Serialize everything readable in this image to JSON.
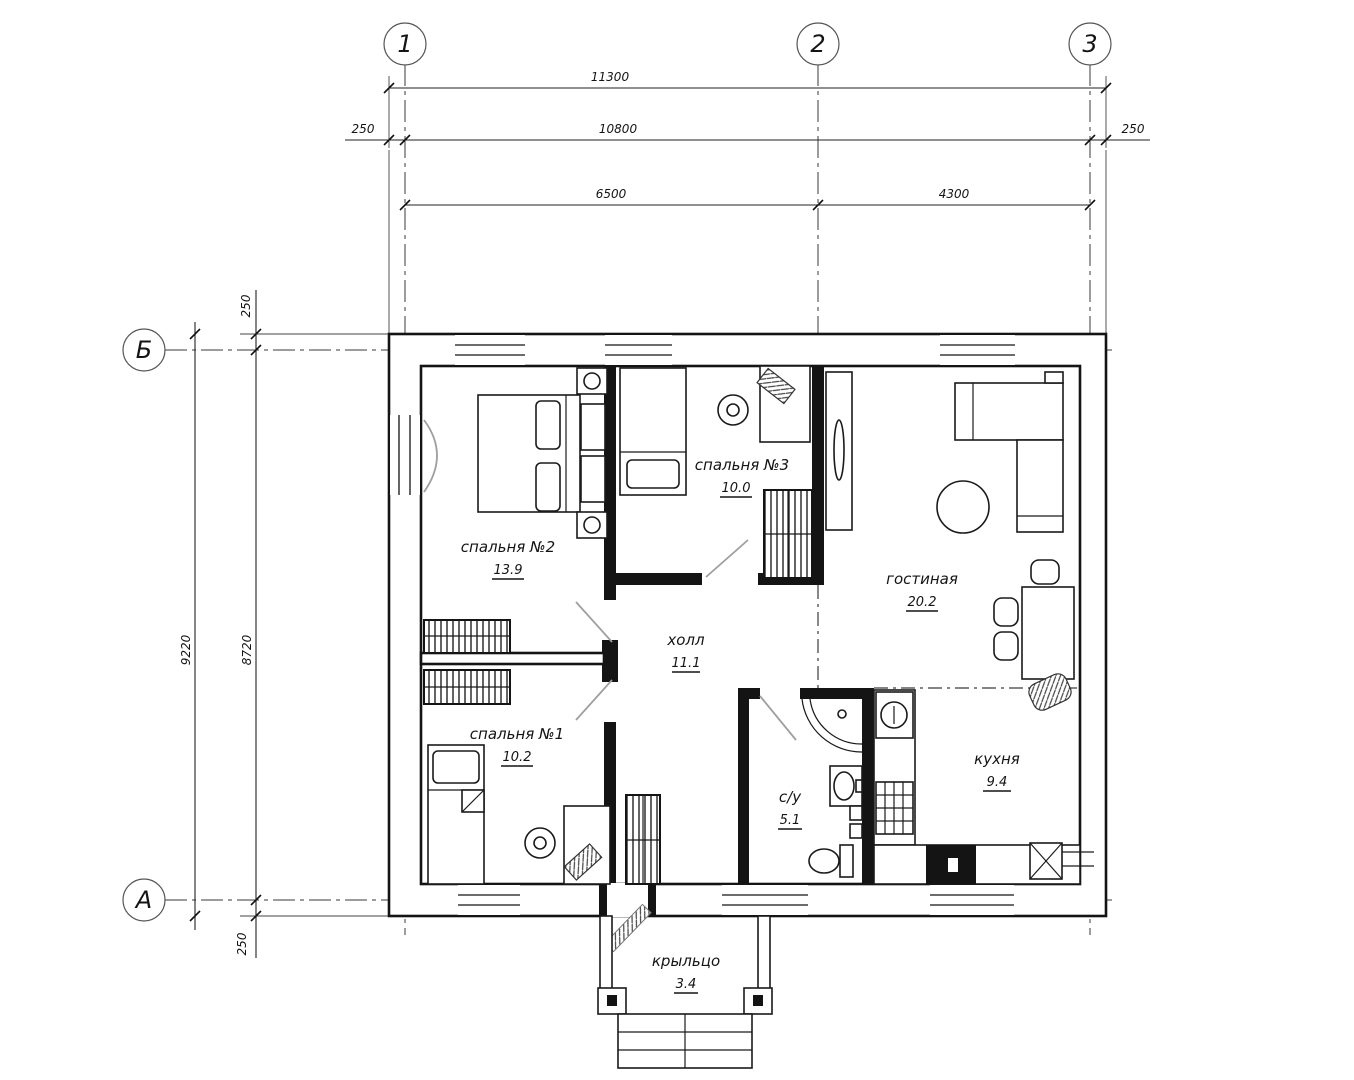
{
  "drawing": {
    "type": "floor-plan",
    "colors": {
      "line": "#141414",
      "door_leaf": "#9f9f9f",
      "background": "#ffffff"
    }
  },
  "axes": {
    "vertical": [
      "1",
      "2",
      "3"
    ],
    "horizontal": [
      "Б",
      "А"
    ]
  },
  "dimensions": {
    "top_total": "11300",
    "top_offset_left": "250",
    "top_inner": "10800",
    "top_offset_right": "250",
    "top_span_1_2": "6500",
    "top_span_2_3": "4300",
    "left_total": "9220",
    "left_inner": "8720",
    "left_offset_top": "250",
    "left_offset_bottom": "250"
  },
  "rooms": {
    "bedroom2": {
      "name": "спальня №2",
      "area": "13.9"
    },
    "bedroom3": {
      "name": "спальня №3",
      "area": "10.0"
    },
    "living": {
      "name": "гостиная",
      "area": "20.2"
    },
    "hall": {
      "name": "холл",
      "area": "11.1"
    },
    "bedroom1": {
      "name": "спальня №1",
      "area": "10.2"
    },
    "bathroom": {
      "name": "с/у",
      "area": "5.1"
    },
    "kitchen": {
      "name": "кухня",
      "area": "9.4"
    },
    "porch": {
      "name": "крыльцо",
      "area": "3.4"
    }
  }
}
